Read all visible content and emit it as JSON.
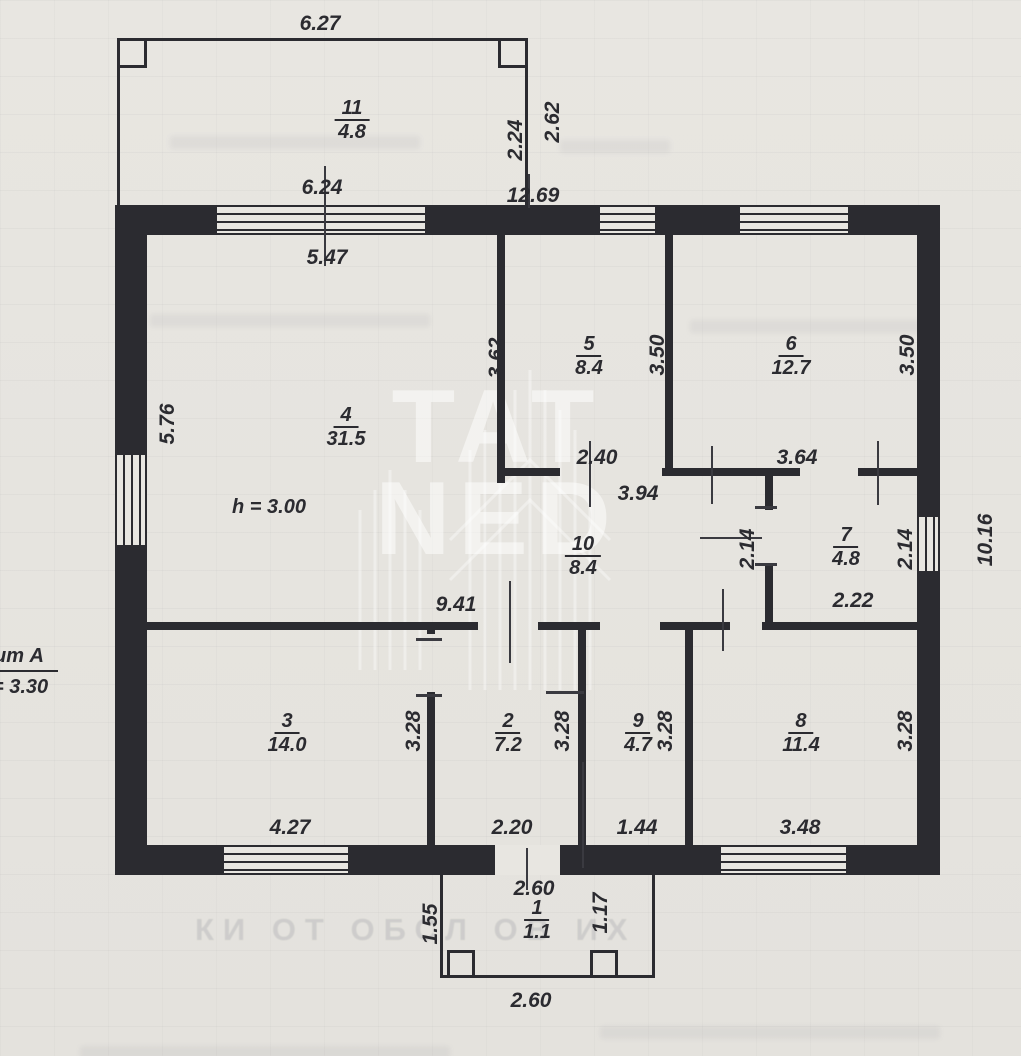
{
  "colors": {
    "paper": "#e8e6e1",
    "ink": "#2b2b30",
    "watermark": "rgba(255,255,255,0.5)"
  },
  "rooms": [
    {
      "number": "1",
      "area": "1.1"
    },
    {
      "number": "2",
      "area": "7.2"
    },
    {
      "number": "3",
      "area": "14.0"
    },
    {
      "number": "4",
      "area": "31.5"
    },
    {
      "number": "5",
      "area": "8.4"
    },
    {
      "number": "6",
      "area": "12.7"
    },
    {
      "number": "7",
      "area": "4.8"
    },
    {
      "number": "8",
      "area": "11.4"
    },
    {
      "number": "9",
      "area": "4.7"
    },
    {
      "number": "10",
      "area": "8.4"
    },
    {
      "number": "11",
      "area": "4.8"
    }
  ],
  "dimensions": [
    {
      "text": "6.27"
    },
    {
      "text": "2.24"
    },
    {
      "text": "2.62"
    },
    {
      "text": "6.24"
    },
    {
      "text": "12.69"
    },
    {
      "text": "5.47"
    },
    {
      "text": "3.62"
    },
    {
      "text": "3.50"
    },
    {
      "text": "3.50"
    },
    {
      "text": "5.76"
    },
    {
      "text": "2.40"
    },
    {
      "text": "3.64"
    },
    {
      "text": "3.94"
    },
    {
      "text": "2.14"
    },
    {
      "text": "2.14"
    },
    {
      "text": "10.16"
    },
    {
      "text": "2.22"
    },
    {
      "text": "9.41"
    },
    {
      "text": "3.28"
    },
    {
      "text": "3.28"
    },
    {
      "text": "3.28"
    },
    {
      "text": "3.28"
    },
    {
      "text": "4.27"
    },
    {
      "text": "2.20"
    },
    {
      "text": "1.44"
    },
    {
      "text": "3.48"
    },
    {
      "text": "2.60"
    },
    {
      "text": "1.55"
    },
    {
      "text": "1.17"
    },
    {
      "text": "2.60"
    }
  ],
  "annotations": {
    "ceiling_height": "h = 3.00",
    "liter": "ит А",
    "liter_height": "= 3.30"
  },
  "watermark": {
    "line1": "TAT",
    "line2": "NED"
  },
  "bleed_text": "КИ ОТ ОБСЛ ОВ ИХ"
}
